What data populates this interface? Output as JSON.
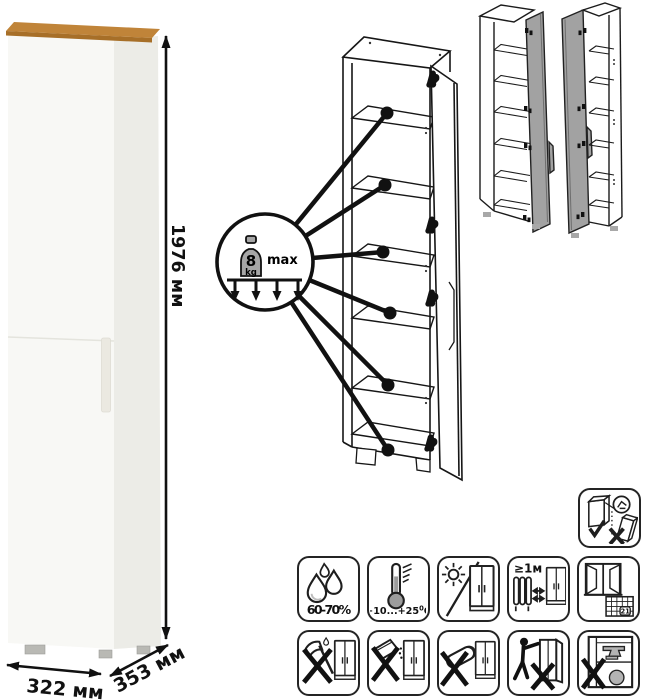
{
  "dimensions": {
    "height_label": "1976 мм",
    "width_label": "322 мм",
    "depth_label": "353 мм"
  },
  "load_callout": {
    "value": "8",
    "unit": "kg",
    "qualifier": "max"
  },
  "care": {
    "humidity_label": "60-70%",
    "temperature_range": "+10...+25",
    "temperature_degree": "0",
    "temperature_unit": "C",
    "heat_distance_label": "≥1м",
    "calendar_day": "21"
  },
  "pictograms": {
    "row1": [
      "humidity-drops",
      "temperature-thermometer",
      "no-direct-sunlight",
      "heat-source-distance",
      "ventilation-window-calendar"
    ],
    "row2": [
      "no-sharp-tools",
      "no-abrasive-powder",
      "no-wet-sponge",
      "no-dragging",
      "no-overloading"
    ],
    "standalone": [
      "anti-tip-wall-anchor"
    ]
  },
  "colors": {
    "wood_top": "#c08439",
    "wood_edge": "#a76f28",
    "cabinet_front": "#f8f8f5",
    "cabinet_side": "#ecece7",
    "door_gray": "#a2a2a2",
    "line": "#1a1a1a",
    "weight_gray": "#a6a6a6",
    "feet_gray": "#b9b9b4"
  }
}
